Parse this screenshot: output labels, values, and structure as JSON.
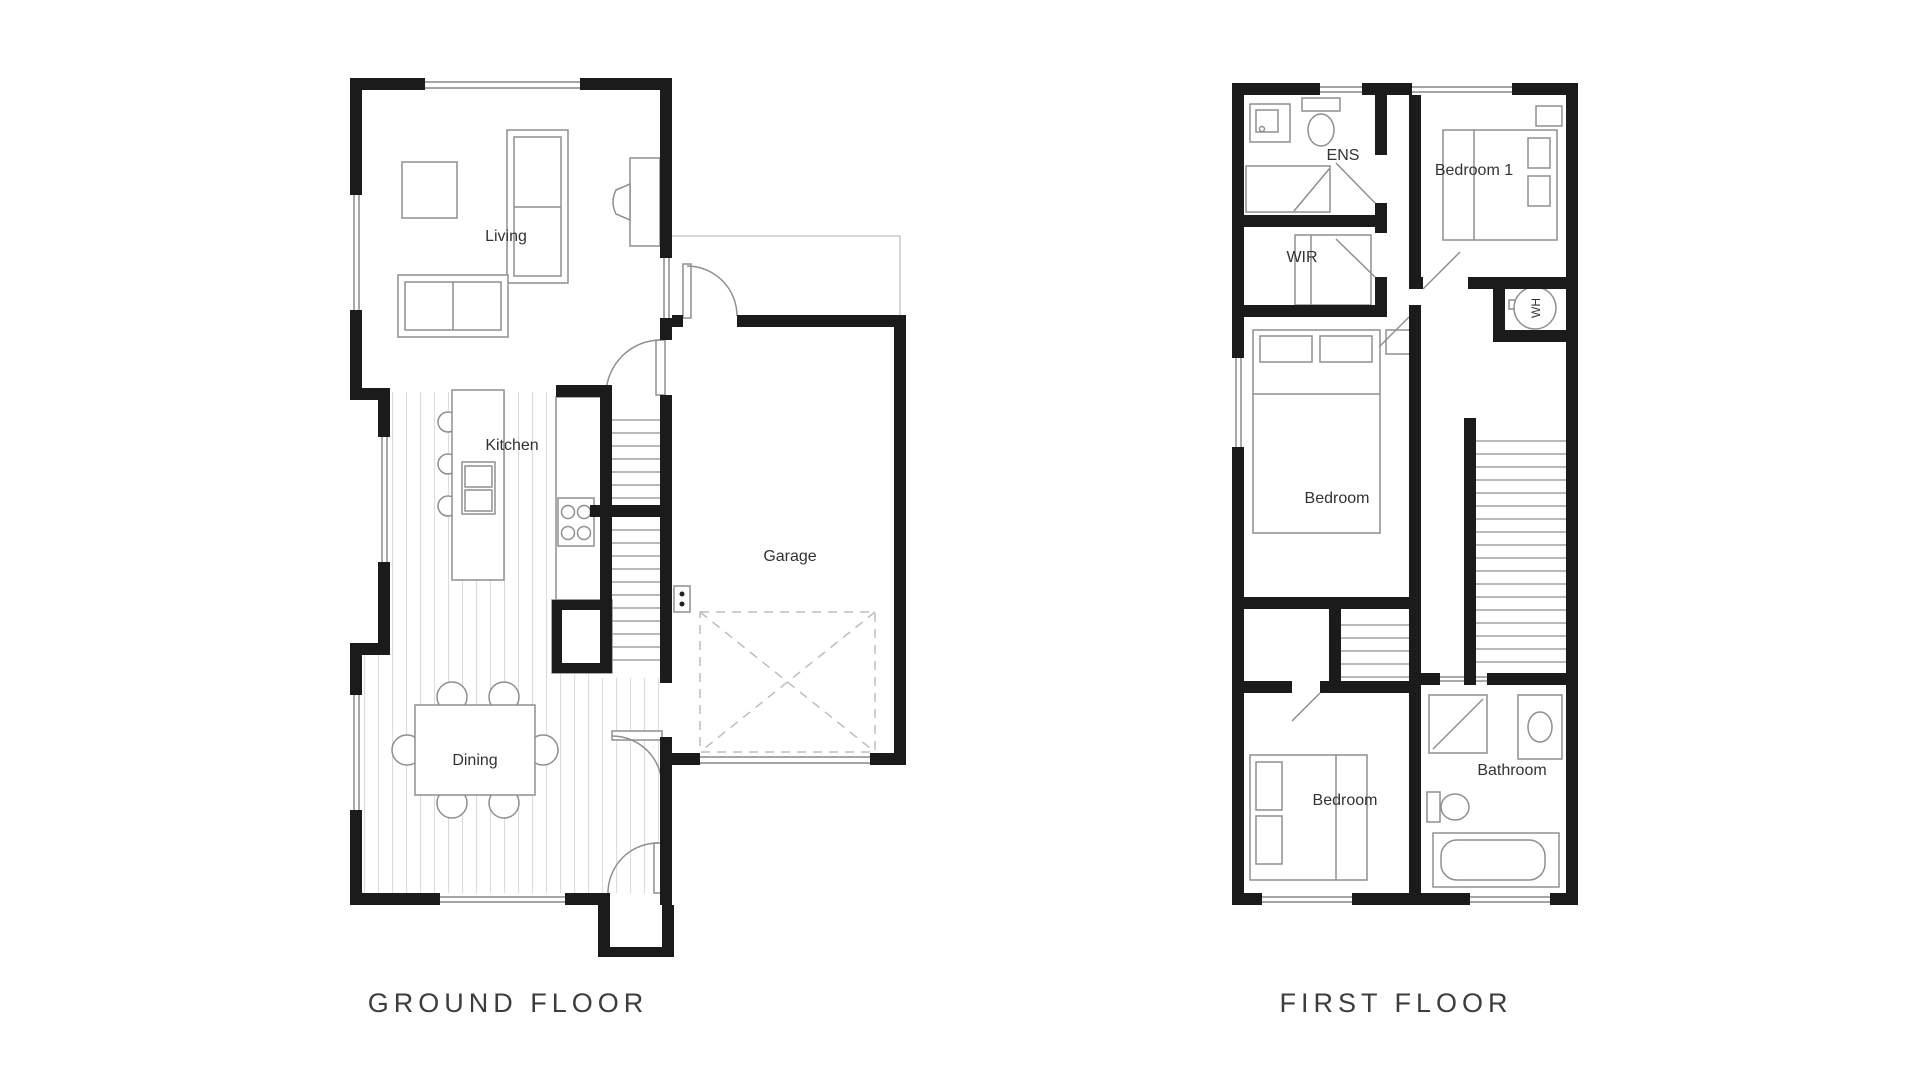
{
  "canvas": {
    "width": 1920,
    "height": 1080,
    "background": "#ffffff"
  },
  "colors": {
    "wall": "#1b1b1b",
    "furniture_line": "#8f8f8f",
    "window_line": "#6f6f6f",
    "floorboard_line": "#dcdcdc",
    "dashed_line": "#bdbdbd",
    "label": "#333333",
    "title": "#3d3d3d"
  },
  "ground_floor": {
    "title": "GROUND FLOOR",
    "rooms": {
      "living": "Living",
      "kitchen": "Kitchen",
      "garage": "Garage",
      "dining": "Dining"
    }
  },
  "first_floor": {
    "title": "FIRST FLOOR",
    "rooms": {
      "ens": "ENS",
      "wir": "WIR",
      "bedroom1": "Bedroom 1",
      "bedroom_middle": "Bedroom",
      "bedroom_rear": "Bedroom",
      "bathroom": "Bathroom",
      "water_heater": "WH"
    }
  }
}
